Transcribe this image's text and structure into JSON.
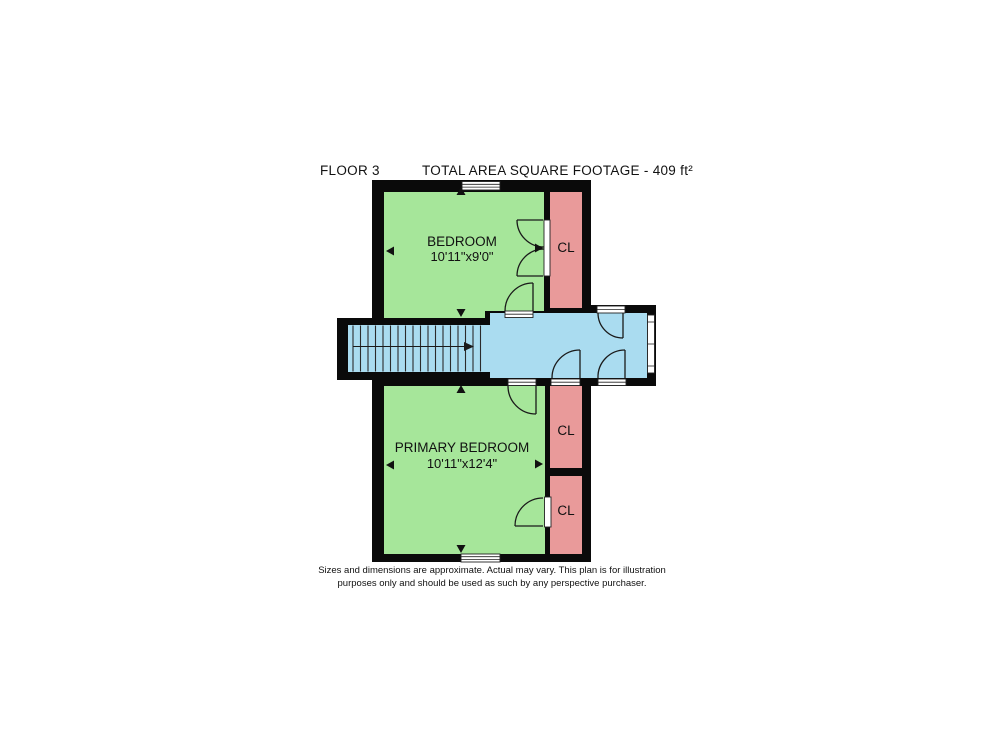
{
  "header": {
    "floor_label": "FLOOR 3",
    "area_label": "TOTAL AREA SQUARE FOOTAGE - 409 ft²"
  },
  "rooms": {
    "bedroom": {
      "name": "BEDROOM",
      "dims": "10'11\"x9'0\""
    },
    "primary_bedroom": {
      "name": "PRIMARY BEDROOM",
      "dims": "10'11\"x12'4\""
    }
  },
  "closets": [
    {
      "label": "CL"
    },
    {
      "label": "CL"
    },
    {
      "label": "CL"
    }
  ],
  "footer": {
    "line1": "Sizes and dimensions are approximate. Actual may vary. This plan is for illustration",
    "line2": "purposes only and should be used as such by any perspective purchaser."
  },
  "colors": {
    "wall": "#0a0a0a",
    "room": "#a6e69a",
    "closet": "#e99a9a",
    "hall": "#aadcf0"
  }
}
